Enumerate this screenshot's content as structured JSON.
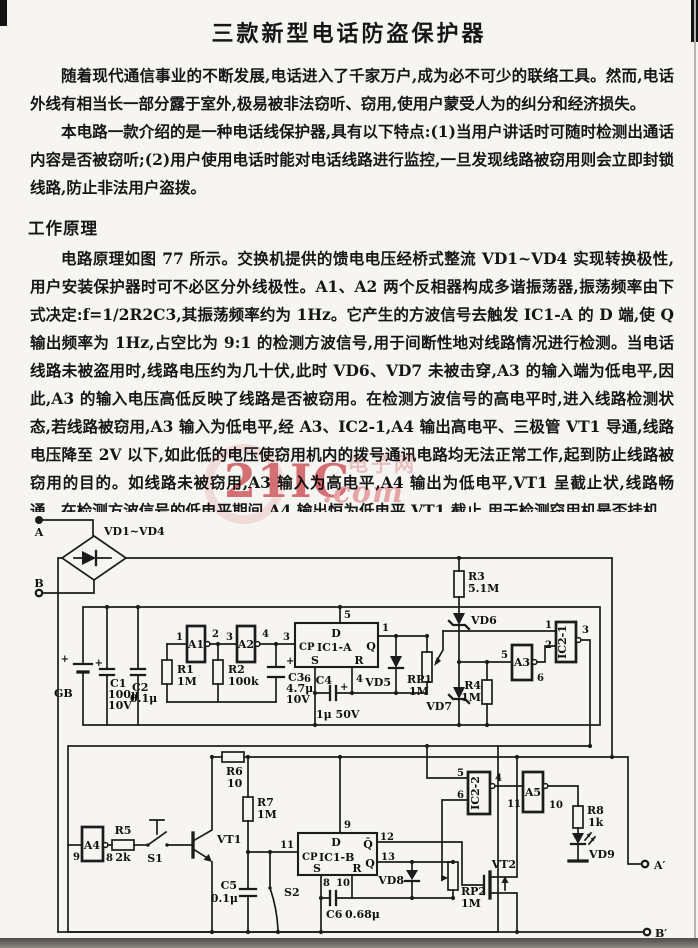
{
  "doc": {
    "title": "三款新型电话防盗保护器",
    "paragraphs": [
      "随着现代通信事业的不断发展,电话进入了千家万户,成为必不可少的联络工具。然而,电话外线有相当长一部分露于室外,极易被非法窃听、窃用,使用户蒙受人为的纠分和经济损失。",
      "本电路一款介绍的是一种电话线保护器,具有以下特点:(1)当用户讲话时可随时检测出通话内容是否被窃听;(2)用户使用电话时能对电话线路进行监控,一旦发现线路被窃用则会立即封锁线路,防止非法用户盗拨。"
    ],
    "section_heading": "工作原理",
    "principle_paragraph": "电路原理如图 77 所示。交换机提供的馈电电压经桥式整流 VD1~VD4 实现转换极性,用户安装保护器时可不必区分外线极性。A1、A2 两个反相器构成多谐振荡器,振荡频率由下式决定:f=1/2R2C3,其振荡频率约为 1Hz。它产生的方波信号去触发 IC1-A 的 D 端,使 Q 输出频率为 1Hz,占空比为 9:1 的检测方波信号,用于间断性地对线路情况进行检测。当电话线路未被盗用时,线路电压约为几十伏,此时 VD6、VD7 未被击穿,A3 的输入端为低电平,因此,A3 的输入电压高低反映了线路是否被窃用。在检测方波信号的高电平时,进入线路检测状态,若线路被窃用,A3 输入为低电平,经 A3、IC2-1,A4 输出高电平、三极管 VT1 导通,线路电压降至 2V 以下,如此低的电压使窃用机内的拨号通讯电路均无法正常工作,起到防止线路被窃用的目的。如线路未被窃用,A3 输入为高电平,A4 输出为低电平,VT1 呈截止状,线路畅通。在检测方波信号的低电平期间,A4 输出恒为低电平,VT1 截止,用于检测窃用机是否挂机。若此时窃用机挂机则线路恢复畅通。"
  },
  "watermark": {
    "main": "21IC",
    "suffix": ".com",
    "tag": "电子网",
    "color_main": "#d4545e",
    "color_suffix": "#eb9aa0",
    "color_tag": "#f0bcc0"
  },
  "circuit": {
    "labels": [
      {
        "id": "terminal-a",
        "t": "A",
        "x": 39,
        "y": 536,
        "a": "middle"
      },
      {
        "id": "terminal-b",
        "t": "B",
        "x": 39,
        "y": 587,
        "a": "middle"
      },
      {
        "id": "bridge",
        "t": "VD1~VD4",
        "x": 104,
        "y": 535,
        "a": "start"
      },
      {
        "id": "battery-plus",
        "t": "+",
        "x": 69,
        "y": 662,
        "a": "end",
        "c": "pin"
      },
      {
        "id": "battery",
        "t": "GB",
        "x": 54,
        "y": 697,
        "a": "start"
      },
      {
        "id": "c1-plus",
        "t": "+",
        "x": 103,
        "y": 666,
        "a": "end",
        "c": "pin"
      },
      {
        "id": "c1",
        "t": "C1",
        "x": 110,
        "y": 687,
        "a": "start"
      },
      {
        "id": "c1-value",
        "t": "100μ",
        "x": 108,
        "y": 698,
        "a": "start"
      },
      {
        "id": "c1-voltage",
        "t": "10V",
        "x": 108,
        "y": 709,
        "a": "start"
      },
      {
        "id": "c2",
        "t": "C2",
        "x": 132,
        "y": 691,
        "a": "start"
      },
      {
        "id": "c2-value",
        "t": "0.1μ",
        "x": 130,
        "y": 702,
        "a": "start"
      },
      {
        "id": "a1",
        "t": "A1",
        "x": 196,
        "y": 648,
        "a": "middle"
      },
      {
        "id": "a1-pin1",
        "t": "1",
        "x": 183,
        "y": 640,
        "a": "end",
        "c": "pin"
      },
      {
        "id": "a1-pin2",
        "t": "2",
        "x": 212,
        "y": 637,
        "a": "start",
        "c": "pin"
      },
      {
        "id": "a2",
        "t": "A2",
        "x": 246,
        "y": 648,
        "a": "middle"
      },
      {
        "id": "a2-pin3",
        "t": "3",
        "x": 233,
        "y": 640,
        "a": "end",
        "c": "pin"
      },
      {
        "id": "a2-pin4",
        "t": "4",
        "x": 262,
        "y": 637,
        "a": "start",
        "c": "pin"
      },
      {
        "id": "r1",
        "t": "R1",
        "x": 177,
        "y": 673,
        "a": "start"
      },
      {
        "id": "r1-value",
        "t": "1M",
        "x": 177,
        "y": 685,
        "a": "start"
      },
      {
        "id": "r2",
        "t": "R2",
        "x": 228,
        "y": 673,
        "a": "start"
      },
      {
        "id": "r2-value",
        "t": "100k",
        "x": 228,
        "y": 685,
        "a": "start"
      },
      {
        "id": "c3-plus",
        "t": "+",
        "x": 286,
        "y": 664,
        "a": "start",
        "c": "pin"
      },
      {
        "id": "c3",
        "t": "C3",
        "x": 288,
        "y": 681,
        "a": "start"
      },
      {
        "id": "c3-value",
        "t": "4.7μ",
        "x": 286,
        "y": 692,
        "a": "start"
      },
      {
        "id": "c3-voltage",
        "t": "10V",
        "x": 286,
        "y": 703,
        "a": "start"
      },
      {
        "id": "ic1a-pin3",
        "t": "3",
        "x": 290,
        "y": 640,
        "a": "end",
        "c": "pin"
      },
      {
        "id": "ic1a-pin5",
        "t": "5",
        "x": 344,
        "y": 618,
        "a": "start",
        "c": "pin"
      },
      {
        "id": "ic1a-pin1",
        "t": "1",
        "x": 382,
        "y": 631,
        "a": "start",
        "c": "pin"
      },
      {
        "id": "ic1a-pin6",
        "t": "6",
        "x": 311,
        "y": 682,
        "a": "end",
        "c": "pin"
      },
      {
        "id": "ic1a-pin4",
        "t": "4",
        "x": 356,
        "y": 682,
        "a": "start",
        "c": "pin"
      },
      {
        "id": "ic1a-d",
        "t": "D",
        "x": 336,
        "y": 637,
        "a": "middle"
      },
      {
        "id": "ic1a-cp",
        "t": "CP",
        "x": 299,
        "y": 650,
        "a": "start",
        "c": "pin"
      },
      {
        "id": "ic1a",
        "t": "IC1-A",
        "x": 317,
        "y": 651,
        "a": "start"
      },
      {
        "id": "ic1a-q",
        "t": "Q",
        "x": 371,
        "y": 650,
        "a": "middle"
      },
      {
        "id": "ic1a-s",
        "t": "S",
        "x": 315,
        "y": 664,
        "a": "middle"
      },
      {
        "id": "ic1a-r",
        "t": "R",
        "x": 359,
        "y": 664,
        "a": "middle"
      },
      {
        "id": "c4",
        "t": "C4",
        "x": 332,
        "y": 684,
        "a": "end"
      },
      {
        "id": "c4-plus",
        "t": "+",
        "x": 340,
        "y": 690,
        "a": "start",
        "c": "pin"
      },
      {
        "id": "c4-value",
        "t": "1μ 50V",
        "x": 316,
        "y": 718,
        "a": "start"
      },
      {
        "id": "vd5",
        "t": "VD5",
        "x": 391,
        "y": 686,
        "a": "end"
      },
      {
        "id": "rp1",
        "t": "RP1",
        "x": 407,
        "y": 683,
        "a": "start"
      },
      {
        "id": "rp1-value",
        "t": "1M",
        "x": 409,
        "y": 695,
        "a": "start"
      },
      {
        "id": "r3",
        "t": "R3",
        "x": 468,
        "y": 580,
        "a": "start"
      },
      {
        "id": "r3-value",
        "t": "5.1M",
        "x": 468,
        "y": 592,
        "a": "start"
      },
      {
        "id": "vd6",
        "t": "VD6",
        "x": 471,
        "y": 624,
        "a": "start"
      },
      {
        "id": "vd7",
        "t": "VD7",
        "x": 452,
        "y": 710,
        "a": "end"
      },
      {
        "id": "r4",
        "t": "R4",
        "x": 481,
        "y": 689,
        "a": "end"
      },
      {
        "id": "r4-value",
        "t": "1M",
        "x": 481,
        "y": 701,
        "a": "end"
      },
      {
        "id": "a3",
        "t": "A3",
        "x": 522,
        "y": 666,
        "a": "middle"
      },
      {
        "id": "a3-pin5",
        "t": "5",
        "x": 508,
        "y": 658,
        "a": "end",
        "c": "pin"
      },
      {
        "id": "a3-pin6",
        "t": "6",
        "x": 537,
        "y": 681,
        "a": "start",
        "c": "pin"
      },
      {
        "id": "ic2-1",
        "t": "IC2-1",
        "x": 566,
        "y": 642,
        "a": "middle",
        "r": -90
      },
      {
        "id": "ic21-pin1",
        "t": "1",
        "x": 552,
        "y": 628,
        "a": "end",
        "c": "pin"
      },
      {
        "id": "ic21-pin2",
        "t": "2",
        "x": 552,
        "y": 648,
        "a": "end",
        "c": "pin"
      },
      {
        "id": "ic21-pin3",
        "t": "3",
        "x": 582,
        "y": 633,
        "a": "start",
        "c": "pin"
      },
      {
        "id": "a4",
        "t": "A4",
        "x": 92,
        "y": 849,
        "a": "middle"
      },
      {
        "id": "a4-pin9",
        "t": "9",
        "x": 80,
        "y": 860,
        "a": "end",
        "c": "pin"
      },
      {
        "id": "a4-pin8",
        "t": "8",
        "x": 106,
        "y": 861,
        "a": "start",
        "c": "pin"
      },
      {
        "id": "r5",
        "t": "R5",
        "x": 123,
        "y": 834,
        "a": "middle"
      },
      {
        "id": "r5-value",
        "t": "2k",
        "x": 123,
        "y": 861,
        "a": "middle"
      },
      {
        "id": "s1",
        "t": "S1",
        "x": 155,
        "y": 862,
        "a": "middle"
      },
      {
        "id": "vt1",
        "t": "VT1",
        "x": 217,
        "y": 843,
        "a": "start"
      },
      {
        "id": "r6",
        "t": "R6",
        "x": 226,
        "y": 775,
        "a": "start"
      },
      {
        "id": "r6-value",
        "t": "10",
        "x": 227,
        "y": 787,
        "a": "start"
      },
      {
        "id": "r7",
        "t": "R7",
        "x": 257,
        "y": 806,
        "a": "start"
      },
      {
        "id": "r7-value",
        "t": "1M",
        "x": 257,
        "y": 818,
        "a": "start"
      },
      {
        "id": "c5",
        "t": "C5",
        "x": 237,
        "y": 889,
        "a": "end"
      },
      {
        "id": "c5-value",
        "t": "0.1μ",
        "x": 238,
        "y": 902,
        "a": "end"
      },
      {
        "id": "s2",
        "t": "S2",
        "x": 284,
        "y": 896,
        "a": "start"
      },
      {
        "id": "ic1b-pin11",
        "t": "11",
        "x": 294,
        "y": 848,
        "a": "end",
        "c": "pin"
      },
      {
        "id": "ic1b-pin9",
        "t": "9",
        "x": 344,
        "y": 828,
        "a": "start",
        "c": "pin"
      },
      {
        "id": "ic1b-pin12",
        "t": "12",
        "x": 380,
        "y": 840,
        "a": "start",
        "c": "pin"
      },
      {
        "id": "ic1b-pin13",
        "t": "13",
        "x": 381,
        "y": 860,
        "a": "start",
        "c": "pin"
      },
      {
        "id": "ic1b-pin8",
        "t": "8",
        "x": 323,
        "y": 886,
        "a": "start",
        "c": "pin"
      },
      {
        "id": "ic1b-pin10",
        "t": "10",
        "x": 350,
        "y": 886,
        "a": "end",
        "c": "pin"
      },
      {
        "id": "ic1b-d",
        "t": "D",
        "x": 336,
        "y": 846,
        "a": "middle"
      },
      {
        "id": "ic1b-cp",
        "t": "CP",
        "x": 302,
        "y": 860,
        "a": "start",
        "c": "pin"
      },
      {
        "id": "ic1b",
        "t": "IC1-B",
        "x": 319,
        "y": 861,
        "a": "start"
      },
      {
        "id": "ic1b-qbar",
        "t": "Q̄",
        "x": 368,
        "y": 848,
        "a": "middle"
      },
      {
        "id": "ic1b-q",
        "t": "Q",
        "x": 370,
        "y": 867,
        "a": "middle"
      },
      {
        "id": "ic1b-s",
        "t": "S",
        "x": 317,
        "y": 872,
        "a": "middle"
      },
      {
        "id": "ic1b-r",
        "t": "R",
        "x": 357,
        "y": 872,
        "a": "middle"
      },
      {
        "id": "c6",
        "t": "C6",
        "x": 326,
        "y": 918,
        "a": "start"
      },
      {
        "id": "c6-value",
        "t": "0.68μ",
        "x": 345,
        "y": 918,
        "a": "start"
      },
      {
        "id": "vd8",
        "t": "VD8",
        "x": 404,
        "y": 884,
        "a": "end"
      },
      {
        "id": "rp2",
        "t": "RP2",
        "x": 461,
        "y": 895,
        "a": "start"
      },
      {
        "id": "rp2-value",
        "t": "1M",
        "x": 461,
        "y": 907,
        "a": "start"
      },
      {
        "id": "ic2-2",
        "t": "IC2-2",
        "x": 479,
        "y": 793,
        "a": "middle",
        "r": -90
      },
      {
        "id": "ic22-pin5",
        "t": "5",
        "x": 464,
        "y": 776,
        "a": "end",
        "c": "pin"
      },
      {
        "id": "ic22-pin6",
        "t": "6",
        "x": 464,
        "y": 798,
        "a": "end",
        "c": "pin"
      },
      {
        "id": "ic22-pin4",
        "t": "4",
        "x": 495,
        "y": 781,
        "a": "start",
        "c": "pin"
      },
      {
        "id": "a5",
        "t": "A5",
        "x": 533,
        "y": 796,
        "a": "middle"
      },
      {
        "id": "a5-pin11",
        "t": "11",
        "x": 521,
        "y": 807,
        "a": "end",
        "c": "pin"
      },
      {
        "id": "a5-pin10",
        "t": "10",
        "x": 549,
        "y": 808,
        "a": "start",
        "c": "pin"
      },
      {
        "id": "r8",
        "t": "R8",
        "x": 587,
        "y": 814,
        "a": "start"
      },
      {
        "id": "r8-value",
        "t": "1k",
        "x": 588,
        "y": 826,
        "a": "start"
      },
      {
        "id": "vd9",
        "t": "VD9",
        "x": 589,
        "y": 858,
        "a": "start"
      },
      {
        "id": "vt2",
        "t": "VT2",
        "x": 516,
        "y": 868,
        "a": "end"
      },
      {
        "id": "terminal-a-prime",
        "t": "A′",
        "x": 654,
        "y": 869,
        "a": "start"
      },
      {
        "id": "terminal-b-prime",
        "t": "B′",
        "x": 655,
        "y": 937,
        "a": "start"
      }
    ]
  }
}
